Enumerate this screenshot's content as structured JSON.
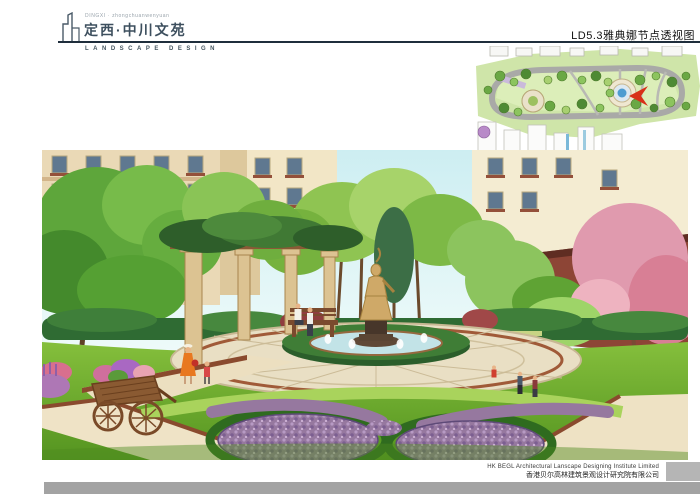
{
  "page": {
    "width": 700,
    "height": 495
  },
  "header": {
    "logo": {
      "tagline": "DINGXI · zhongchuanwenyuan",
      "title": "定西·中川文苑",
      "subtitle": "LANDSCAPE DESIGN"
    },
    "sheet_title": "LD5.3雅典娜节点透视图"
  },
  "inset": {
    "kind": "site-plan-key-map",
    "marker_color": "#d83018"
  },
  "footer": {
    "company_en": "HK BEGL Architectural Lanscape Designing Institute Limited",
    "company_cn": "香港贝尔高林建筑景观设计研究院有限公司"
  },
  "colors": {
    "logo_text": "#3d4f5e",
    "header_rule": "#1f2e3c",
    "footer_bar": "#a3a3a3",
    "footer_block": "#b5b5b5",
    "sky": "#cdeef2",
    "lawn_green": "#6fae2e",
    "flower_purple": "#96789f",
    "building_tan": "#ead9b6",
    "building_red": "#8d4536"
  }
}
